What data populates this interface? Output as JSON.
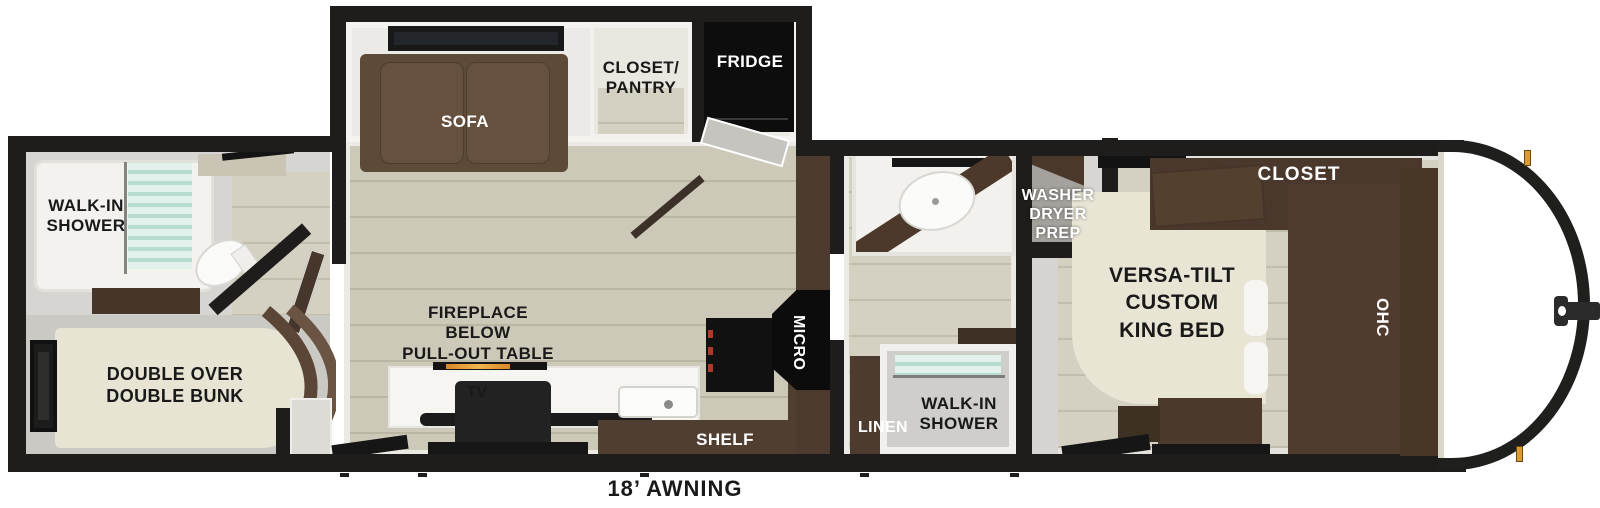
{
  "diagram": {
    "type": "rv-travel-trailer-floorplan",
    "awning_label": "18’ AWNING",
    "rooms": {
      "rear_bath": {
        "shower": "WALK-IN\nSHOWER"
      },
      "bunk_room": {
        "bunk": "DOUBLE OVER\nDOUBLE BUNK"
      },
      "living_kitchen": {
        "sofa": "SOFA",
        "closet_pantry": "CLOSET/\nPANTRY",
        "fridge": "FRIDGE",
        "fireplace": "FIREPLACE\nBELOW\nPULL-OUT TABLE",
        "tv": "TV",
        "micro": "MICRO",
        "shelf": "SHELF"
      },
      "mid_bath": {
        "washer": "WASHER\nDRYER\nPREP",
        "linen": "LINEN",
        "shower": "WALK-IN\nSHOWER"
      },
      "bedroom": {
        "bed": "VERSA-TILT\nCUSTOM\nKING BED",
        "closet": "CLOSET",
        "ohc": "OHC"
      }
    },
    "colors": {
      "wall": "#1e1d1b",
      "wood_floor": "#ccc8b7",
      "cabinet_brown": "#4a382b",
      "sofa_brown": "#5e4a39",
      "mattress_cream": "#e8e4d3",
      "appliance_black": "#141414",
      "glass_teal": "#cfe8e1",
      "fireplace_amber": "#e09a33",
      "marker_light_amber": "#dd9a33"
    }
  }
}
